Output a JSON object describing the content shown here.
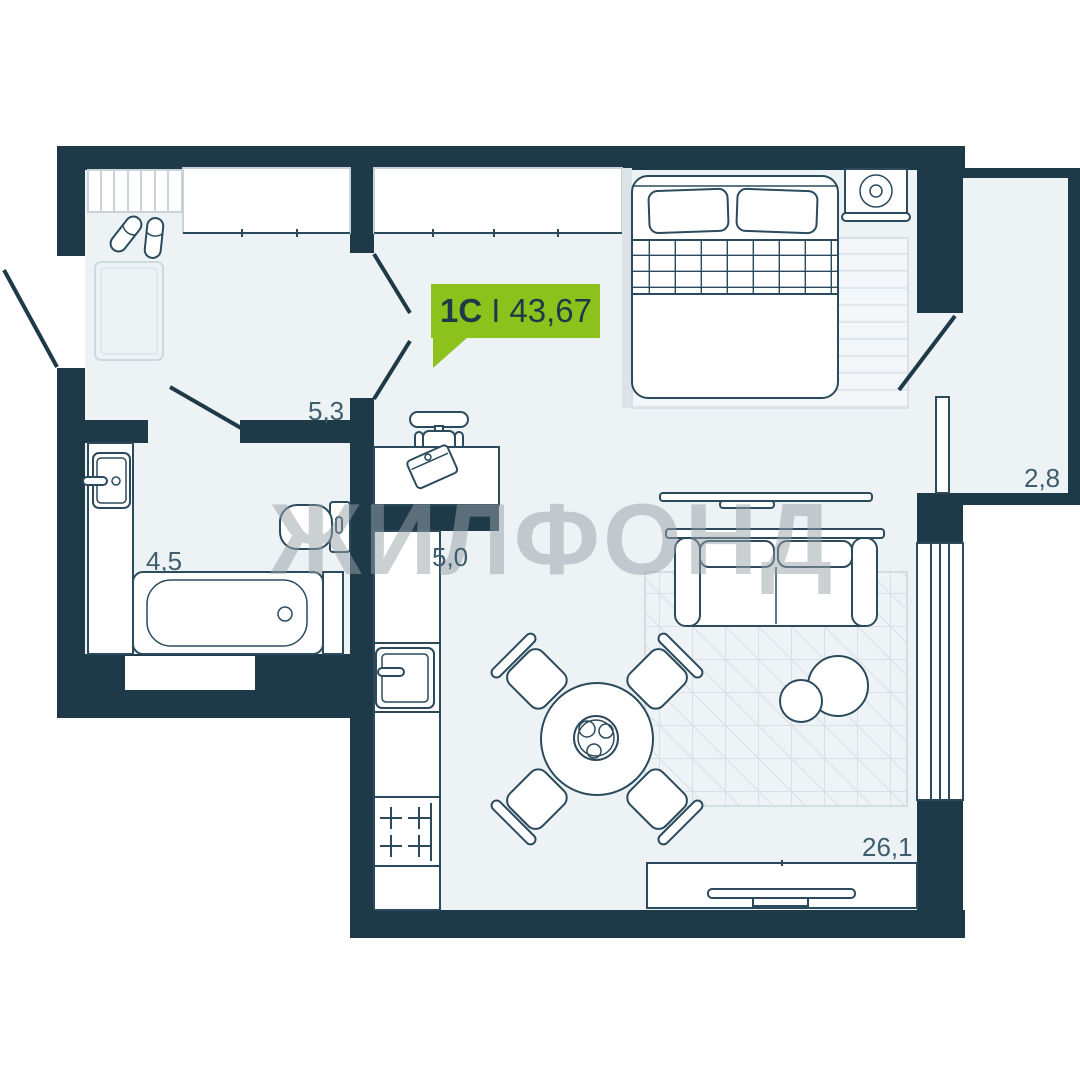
{
  "plan": {
    "badge": {
      "type_label": "1С",
      "divider": "I",
      "area_value": "43,67"
    },
    "watermark_text": "ЖИЛФОНД",
    "rooms": {
      "hallway": {
        "area": "5,3"
      },
      "bathroom": {
        "area": "4,5"
      },
      "kitchen": {
        "area": "5,0"
      },
      "living": {
        "area": "26,1"
      },
      "balcony": {
        "area": "2,8"
      }
    },
    "colors": {
      "background": "#ffffff",
      "wall": "#1e3a49",
      "floor": "#edf2f5",
      "outline": "#2b4b5d",
      "light_outline": "#c8d2d8",
      "accent_green": "#8dc21c",
      "label_text": "#3f5e6d",
      "watermark_gray": "#98a2a9"
    }
  }
}
